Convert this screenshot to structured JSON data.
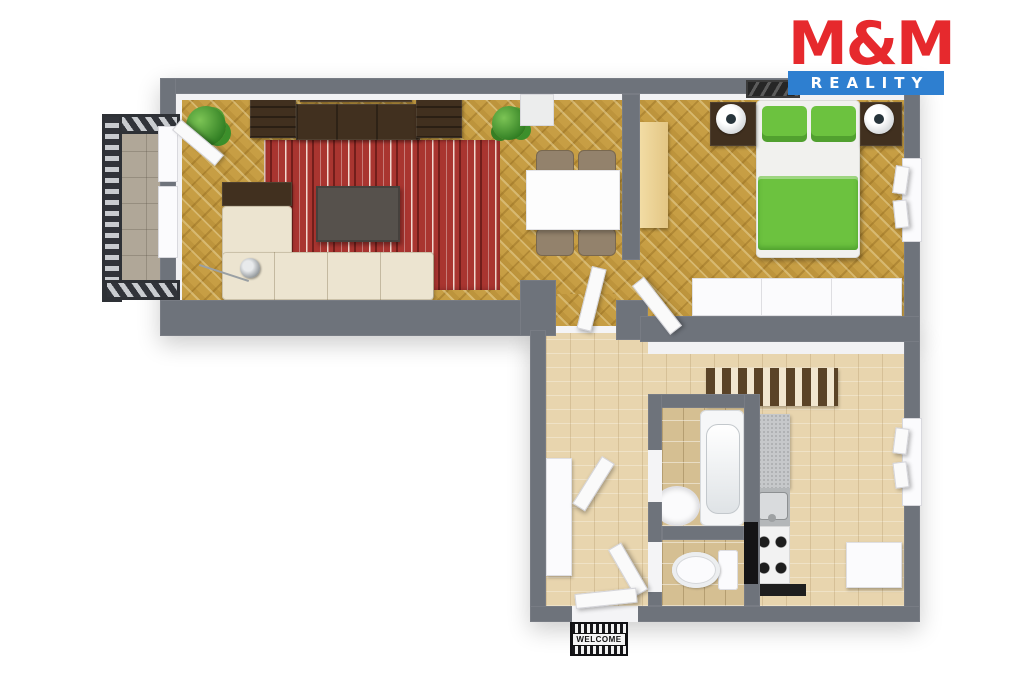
{
  "brand": {
    "name_top": "M&M",
    "name_bottom": "REALITY"
  },
  "doormat_text": "WELCOME",
  "colors": {
    "logo_red": "#e6292d",
    "logo_blue": "#2e7fd0",
    "wall": "#6e737b",
    "herringbone": "#c79e44",
    "plank": "#e8d5ae",
    "tile": "#d5bf92",
    "balcony_tile": "#b0a798",
    "rug_red": "#a93530",
    "bed_green": "#6cc23f",
    "wood_dark": "#41301f",
    "cream_sofa": "#ece4d0"
  }
}
